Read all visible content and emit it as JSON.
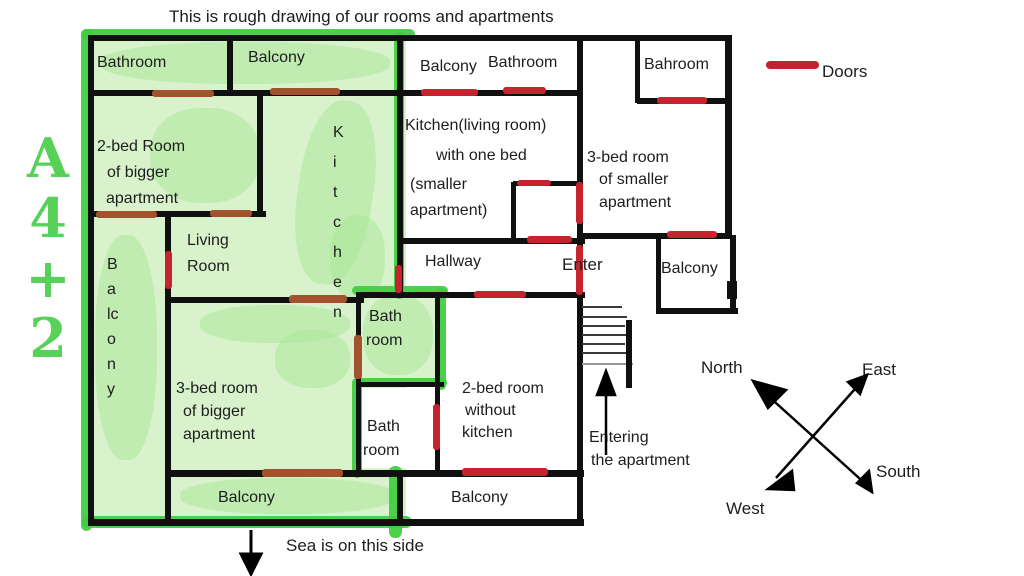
{
  "title": "This is rough drawing of our rooms and apartments",
  "legend": {
    "doors": "Doors"
  },
  "compass": {
    "north": "North",
    "east": "East",
    "south": "South",
    "west": "West"
  },
  "annotations": {
    "highlight_code": [
      "A",
      "4",
      "+",
      "2"
    ],
    "sea_note": "Sea is on this side",
    "entering": [
      "Entering",
      "the apartment"
    ],
    "enter": "Enter"
  },
  "rooms": {
    "bathroom_big": "Bathroom",
    "balcony_big_top": "Balcony",
    "room2_big": [
      "2-bed Room",
      "of bigger",
      "apartment"
    ],
    "kitchen_big_vertical": [
      "K",
      "i",
      "t",
      "c",
      "h",
      "e",
      "n"
    ],
    "living_room": [
      "Living",
      "Room"
    ],
    "balcony_big_left_vertical": [
      "B",
      "a",
      "lc",
      "o",
      "n",
      "y"
    ],
    "room3_big": [
      "3-bed room",
      "of bigger",
      "apartment"
    ],
    "bath_upper": [
      "Bath",
      "room"
    ],
    "bath_lower": [
      "Bath",
      "room"
    ],
    "balcony_bottom_left": "Balcony",
    "balcony_mid_top": "Balcony",
    "bathroom_mid": "Bathroom",
    "kitchen_small": [
      "Kitchen(living room)",
      "with one bed",
      "(smaller",
      "apartment)"
    ],
    "hallway": "Hallway",
    "room2_small": [
      "2-bed room",
      "without",
      "kitchen"
    ],
    "balcony_bottom_right": "Balcony",
    "bahroom_small": "Bahroom",
    "room3_small": [
      "3-bed room",
      "of smaller",
      "apartment"
    ],
    "balcony_right": "Balcony"
  },
  "colors": {
    "highlight_fill": "#d8f3cb",
    "highlight_marker": "#3ecd3e",
    "wall": "#101010",
    "door_red": "#c5242e",
    "door_brown": "#a2532e",
    "code_green": "#58d158"
  }
}
